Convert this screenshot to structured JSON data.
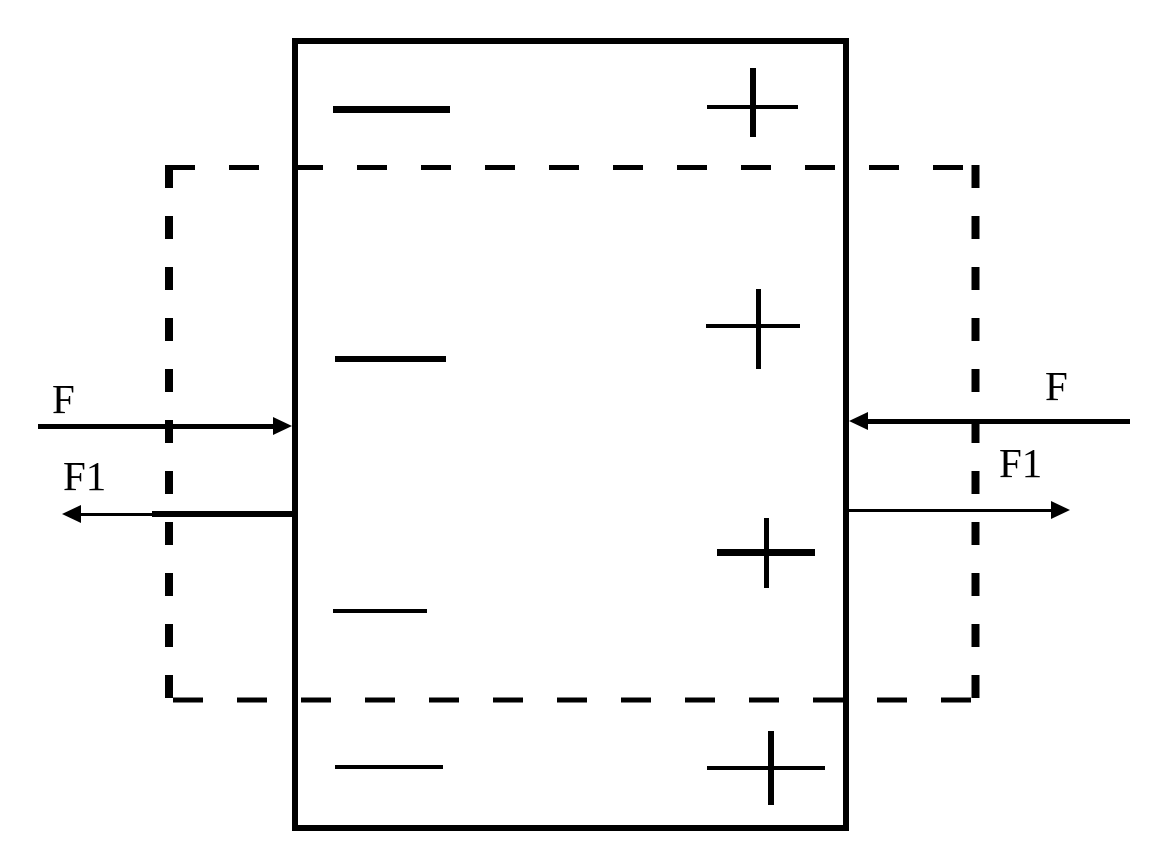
{
  "diagram": {
    "colors": {
      "ink": "#000000",
      "background": "#ffffff"
    },
    "solid_box": {
      "x": 292,
      "y": 38,
      "w": 557,
      "h": 793,
      "stroke": 6
    },
    "dashed_box": {
      "x": 165,
      "y": 165,
      "w": 814,
      "h": 537
    },
    "minus_signs": [
      {
        "x": 333,
        "y": 106,
        "w": 117,
        "h": 7
      },
      {
        "x": 335,
        "y": 356,
        "w": 111,
        "h": 6
      },
      {
        "x": 333,
        "y": 609,
        "w": 94,
        "h": 4
      },
      {
        "x": 335,
        "y": 765,
        "w": 108,
        "h": 4
      }
    ],
    "plus_signs": [
      {
        "h": {
          "x": 707,
          "y": 105,
          "w": 91,
          "h": 4
        },
        "v": {
          "x": 750,
          "y": 68,
          "w": 6,
          "h": 69
        }
      },
      {
        "h": {
          "x": 706,
          "y": 324,
          "w": 94,
          "h": 4
        },
        "v": {
          "x": 756,
          "y": 289,
          "w": 5,
          "h": 80
        }
      },
      {
        "h": {
          "x": 717,
          "y": 549,
          "w": 98,
          "h": 7
        },
        "v": {
          "x": 764,
          "y": 518,
          "w": 5,
          "h": 70
        }
      },
      {
        "h": {
          "x": 707,
          "y": 766,
          "w": 118,
          "h": 4
        },
        "v": {
          "x": 768,
          "y": 731,
          "w": 6,
          "h": 74
        }
      }
    ],
    "arrows": {
      "left_f": {
        "label": "F",
        "lines": [
          {
            "x": 38,
            "y": 424,
            "w": 238,
            "h": 5
          }
        ],
        "head": {
          "dir": "right",
          "x": 292,
          "y": 426
        }
      },
      "left_f1": {
        "label": "F1",
        "lines": [
          {
            "x": 80,
            "y": 513,
            "w": 75,
            "h": 3
          },
          {
            "x": 152,
            "y": 511,
            "w": 141,
            "h": 6
          }
        ],
        "head": {
          "dir": "left",
          "x": 62,
          "y": 514
        }
      },
      "right_f": {
        "label": "F",
        "lines": [
          {
            "x": 866,
            "y": 419,
            "w": 264,
            "h": 5
          }
        ],
        "head": {
          "dir": "left",
          "x": 849,
          "y": 421
        }
      },
      "right_f1": {
        "label": "F1",
        "lines": [
          {
            "x": 848,
            "y": 509,
            "w": 206,
            "h": 3
          }
        ],
        "head": {
          "dir": "right",
          "x": 1070,
          "y": 510
        }
      }
    }
  }
}
